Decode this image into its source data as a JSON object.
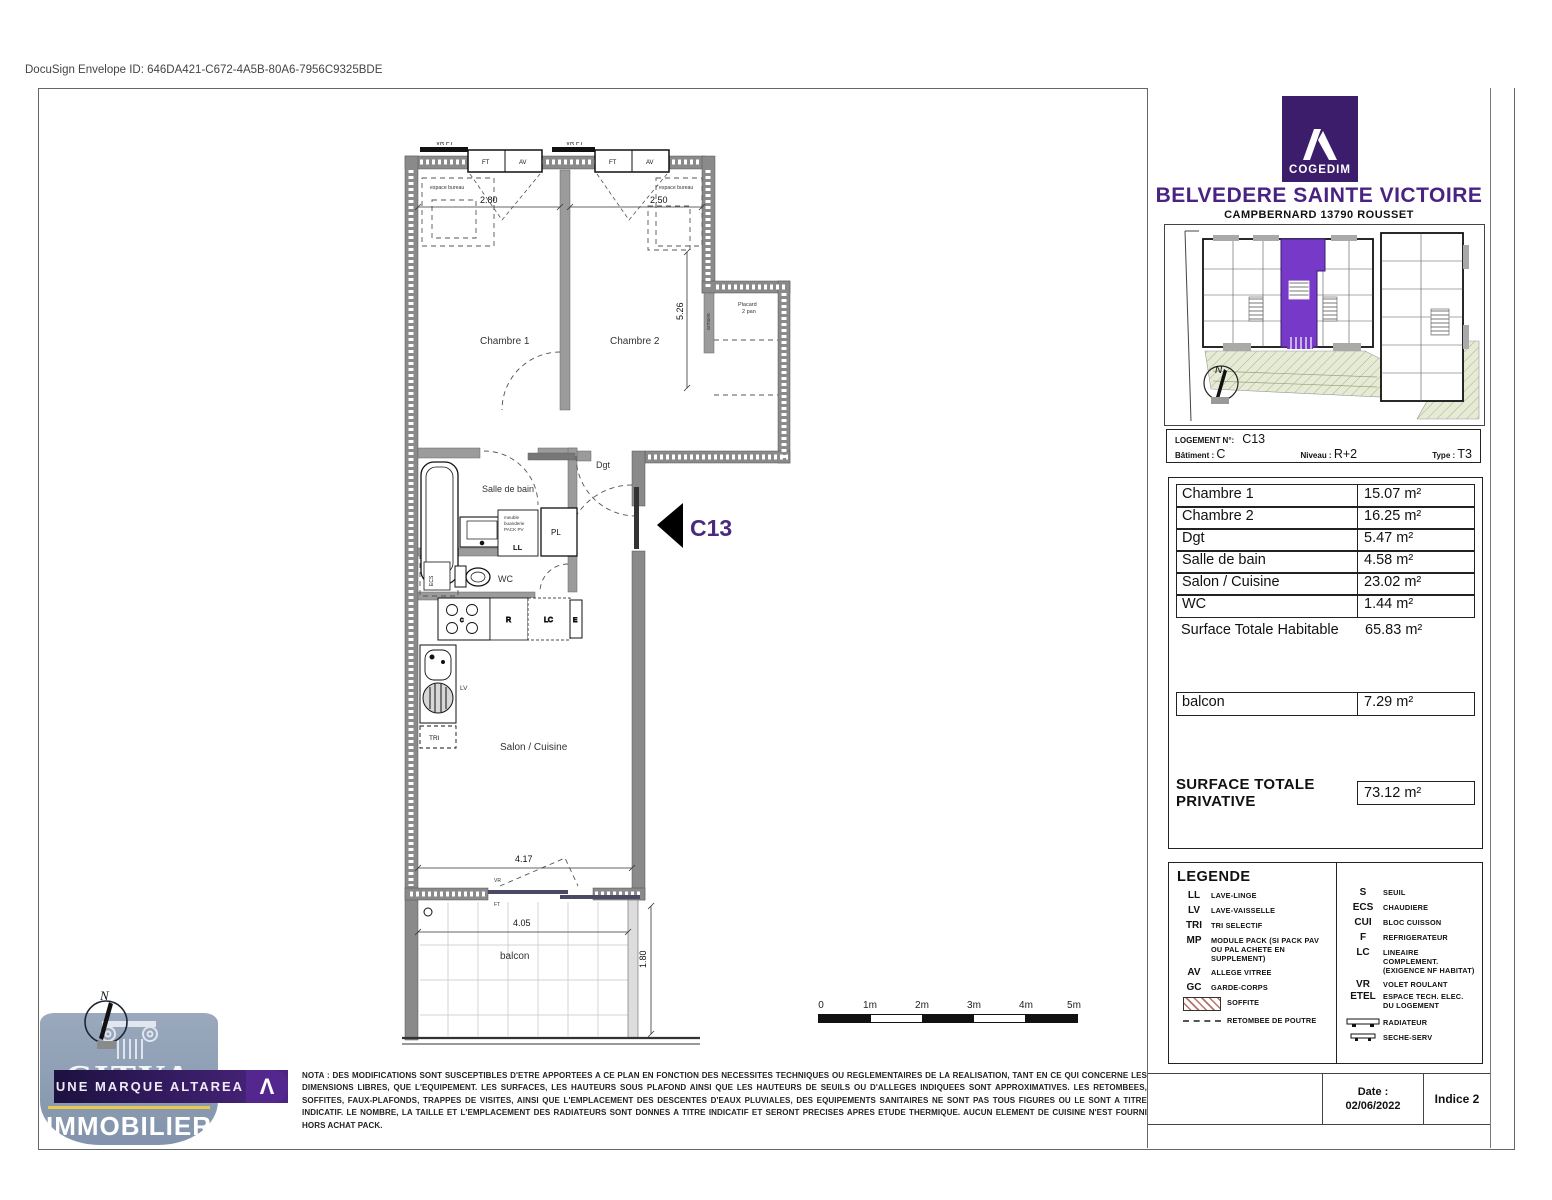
{
  "page": {
    "docusign": "DocuSign Envelope ID: 646DA421-C672-4A5B-80A6-7956C9325BDE"
  },
  "header": {
    "brand": "COGEDIM",
    "title": "BELVEDERE SAINTE VICTOIRE",
    "subtitle": "CAMPBERNARD 13790 ROUSSET"
  },
  "unit_info": {
    "logement_label": "LOGEMENT N°:",
    "logement_value": "C13",
    "batiment_label": "Bâtiment :",
    "batiment_value": "C",
    "niveau_label": "Niveau :",
    "niveau_value": "R+2",
    "type_label": "Type :",
    "type_value": "T3"
  },
  "areas": {
    "rows": [
      {
        "label": "Chambre 1",
        "value": "15.07 m²"
      },
      {
        "label": "Chambre 2",
        "value": "16.25 m²"
      },
      {
        "label": "Dgt",
        "value": "5.47 m²"
      },
      {
        "label": "Salle de bain",
        "value": "4.58 m²"
      },
      {
        "label": "Salon / Cuisine",
        "value": "23.02 m²"
      },
      {
        "label": "WC",
        "value": "1.44 m²"
      }
    ],
    "total_label": "Surface Totale Habitable",
    "total_value": "65.83 m²",
    "balcon_label": "balcon",
    "balcon_value": "7.29 m²",
    "privative_label": "SURFACE TOTALE PRIVATIVE",
    "privative_value": "73.12 m²"
  },
  "legend": {
    "title": "LEGENDE",
    "left": [
      {
        "abbr": "LL",
        "label": "LAVE-LINGE"
      },
      {
        "abbr": "LV",
        "label": "LAVE-VAISSELLE"
      },
      {
        "abbr": "TRI",
        "label": "TRI SELECTIF"
      },
      {
        "abbr": "MP",
        "label": "MODULE PACK (SI PACK PAV OU PAL ACHETE EN SUPPLEMENT)"
      },
      {
        "abbr": "AV",
        "label": "ALLEGE VITREE"
      },
      {
        "abbr": "GC",
        "label": "GARDE-CORPS"
      }
    ],
    "soffite_label": "SOFFITE",
    "retombee_label": "RETOMBEE DE POUTRE",
    "right": [
      {
        "abbr": "S",
        "label": "SEUIL"
      },
      {
        "abbr": "ECS",
        "label": "CHAUDIERE"
      },
      {
        "abbr": "CUI",
        "label": "BLOC CUISSON"
      },
      {
        "abbr": "F",
        "label": "REFRIGERATEUR"
      },
      {
        "abbr": "LC",
        "label": "LINEAIRE COMPLEMENT. (EXIGENCE NF HABITAT)"
      },
      {
        "abbr": "VR",
        "label": "VOLET ROULANT"
      },
      {
        "abbr": "ETEL",
        "label": "ESPACE TECH. ELEC. DU LOGEMENT"
      }
    ],
    "radiateur_label": "RADIATEUR",
    "seche_label": "SECHE-SERV"
  },
  "strip": {
    "date_label": "Date :",
    "date_value": "02/06/2022",
    "indice": "Indice 2"
  },
  "nota": "NOTA : DES MODIFICATIONS SONT SUSCEPTIBLES D'ETRE APPORTEES A CE PLAN EN FONCTION DES NECESSITES TECHNIQUES OU REGLEMENTAIRES DE LA REALISATION, TANT EN CE QUI CONCERNE LES DIMENSIONS LIBRES, QUE L'EQUIPEMENT. LES SURFACES, LES HAUTEURS SOUS PLAFOND AINSI QUE LES HAUTEURS DE SEUILS OU D'ALLEGES INDIQUEES SONT APPROXIMATIVES. LES RETOMBEES, SOFFITES, FAUX-PLAFONDS, TRAPPES DE VISITES, AINSI QUE L'EMPLACEMENT DES DESCENTES D'EAUX PLUVIALES, DES EQUIPEMENTS SANITAIRES NE SONT PAS TOUS FIGURES OU LE SONT A TITRE INDICATIF. LE NOMBRE, LA TAILLE ET L'EMPLACEMENT DES RADIATEURS SONT DONNES A TITRE INDICATIF ET SERONT PRECISES APRES ETUDE THERMIQUE. AUCUN ELEMENT DE CUISINE N'EST FOURNI HORS ACHAT PACK.",
  "scalebar": {
    "t0": "0",
    "t1": "1m",
    "t2": "2m",
    "t3": "3m",
    "t4": "4m",
    "t5": "5m"
  },
  "citya": {
    "name": "CITYA",
    "banner": "UNE MARQUE ALTAREA",
    "lambda": "Λ",
    "word": "IMMOBILIER",
    "north": "N"
  },
  "keyplan": {
    "north": "N"
  },
  "plan": {
    "c13": "C13",
    "rooms": {
      "chambre1": "Chambre 1",
      "chambre2": "Chambre 2",
      "dgt": "Dgt",
      "sdb": "Salle de bain",
      "wc": "WC",
      "salon": "Salon / Cuisine",
      "balcon": "balcon"
    },
    "dims": {
      "d280": "2.80",
      "d250": "2.50",
      "d526": "5.26",
      "d417": "4.17",
      "d405": "4.05",
      "d180": "1.80"
    },
    "tiny": {
      "vrft": "VR FT",
      "ft": "FT",
      "av": "AV",
      "espace": "espace bureau",
      "placard1": "Placard",
      "placard2": "2 pan",
      "armoire": "armoire",
      "pl": "PL",
      "ll": "LL",
      "mp1": "meuble",
      "mp2": "buanderie",
      "mp3": "PACK PV",
      "ecs": "ECS",
      "c": "C",
      "r": "R",
      "lc": "LC",
      "e": "E",
      "lv": "LV",
      "tri": "TRI",
      "vr": "VR",
      "ft2": "FT"
    }
  },
  "colors": {
    "title_purple": "#4a2382",
    "cogedim_purple": "#3b1d6b",
    "unit_highlight": "#7639c8",
    "wall_gray": "#8a8a8a",
    "gold": "#e8c94e"
  }
}
